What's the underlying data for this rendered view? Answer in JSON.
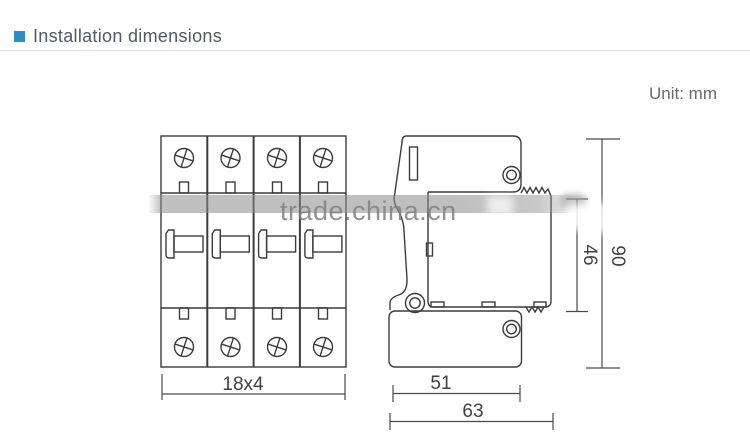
{
  "header": {
    "title": "Installation dimensions",
    "bullet_color": "#2d8dcb"
  },
  "unit_label": "Unit: mm",
  "watermark": {
    "text": "trade.china.cn"
  },
  "diagram": {
    "front_view": {
      "description": "front view of 4-module DIN device",
      "modules": 4,
      "width_label": "18x4"
    },
    "side_view": {
      "description": "side profile of DIN-rail device",
      "width_label": "51",
      "overall_width_label": "63",
      "body_height_label": "46",
      "overall_height_label": "90"
    }
  },
  "colors": {
    "accent_blue": "#2d8dcb",
    "line_gray": "#3c3c3c",
    "watermark_gray": "#808080",
    "rule_gray": "#dedede"
  }
}
